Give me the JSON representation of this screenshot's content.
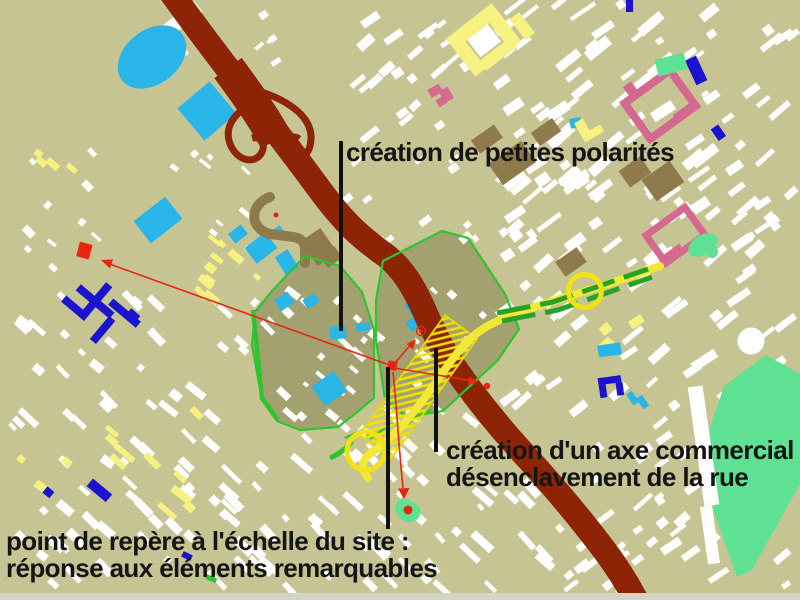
{
  "annotations": {
    "polarities": {
      "text": "création de petites polarités"
    },
    "commercial_axis": {
      "line1": "création d'un axe commercial",
      "line2": "désenclavement de la rue"
    },
    "landmark": {
      "line1": "point de repère à l'échelle du site :",
      "line2": "réponse aux éléments remarquables"
    }
  },
  "map": {
    "background_color": "#c6c493",
    "features": [
      {
        "name": "motorway",
        "color": "#8c2405"
      },
      {
        "name": "site-boundary",
        "color": "#2fc42f"
      },
      {
        "name": "commercial-axis-hatch",
        "color": "#f0e400"
      },
      {
        "name": "yellow-route",
        "color": "#f2e838"
      },
      {
        "name": "green-axis",
        "color": "#27a227"
      },
      {
        "name": "sports-facilities",
        "color": "#29b5e8"
      },
      {
        "name": "institutional-buildings",
        "color": "#d4688e"
      },
      {
        "name": "park",
        "color": "#5fe193"
      },
      {
        "name": "civic-buildings",
        "color": "#1c13cf"
      },
      {
        "name": "existing-fabric",
        "color": "#ffffff"
      },
      {
        "name": "secondary-fabric",
        "color": "#f7f182"
      },
      {
        "name": "accent-markers",
        "color": "#e8250f"
      },
      {
        "name": "leader-lines",
        "color": "#111111"
      }
    ]
  }
}
